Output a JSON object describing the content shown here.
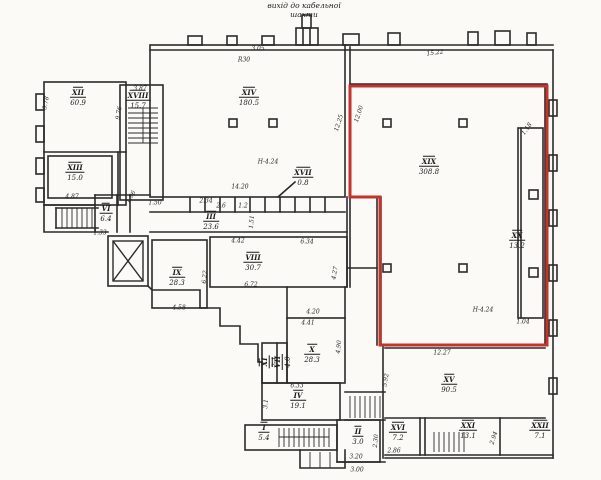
{
  "document": {
    "kind": "scanned hand-drawn floor plan",
    "paper_color": "#fbfaf6",
    "ink_color": "#2a2a2a"
  },
  "annotations": {
    "top_note_line1": "вихід до кабельної",
    "top_note_line2": "шахти"
  },
  "highlight": {
    "color": "#c4342c",
    "room_label": "XIX",
    "room_area": "308.8"
  },
  "plan": {
    "rooms": [
      {
        "label": "XII",
        "area": "60.9",
        "x": 78,
        "y": 97
      },
      {
        "label": "XVIII",
        "area": "15.7",
        "x": 138,
        "y": 100
      },
      {
        "label": "XIII",
        "area": "15.0",
        "x": 75,
        "y": 172
      },
      {
        "label": "XIV",
        "area": "180.5",
        "x": 249,
        "y": 97
      },
      {
        "label": "XIX",
        "area": "308.8",
        "x": 429,
        "y": 166
      },
      {
        "label": "XX",
        "area": "13.2",
        "x": 517,
        "y": 240
      },
      {
        "label": "VIII",
        "area": "30.7",
        "x": 253,
        "y": 262
      },
      {
        "label": "IX",
        "area": "28.3",
        "x": 177,
        "y": 277
      },
      {
        "label": "III",
        "area": "23.6",
        "x": 211,
        "y": 221
      },
      {
        "label": "VI",
        "area": "6.4",
        "x": 106,
        "y": 213
      },
      {
        "label": "X",
        "area": "28.3",
        "x": 312,
        "y": 354
      },
      {
        "label": "XI",
        "area": "2.1",
        "x": 269,
        "y": 362,
        "r": -90
      },
      {
        "label": "VII",
        "area": "4.0",
        "x": 282,
        "y": 362,
        "r": -90
      },
      {
        "label": "IV",
        "area": "19.1",
        "x": 298,
        "y": 400
      },
      {
        "label": "I",
        "area": "5.4",
        "x": 264,
        "y": 432
      },
      {
        "label": "II",
        "area": "3.0",
        "x": 358,
        "y": 436
      },
      {
        "label": "XV",
        "area": "90.5",
        "x": 449,
        "y": 384
      },
      {
        "label": "XVI",
        "area": "7.2",
        "x": 398,
        "y": 432
      },
      {
        "label": "XXI",
        "area": "13.1",
        "x": 468,
        "y": 430
      },
      {
        "label": "XXII",
        "area": "7.1",
        "x": 540,
        "y": 430
      },
      {
        "label": "XVII",
        "area": "0.8",
        "x": 303,
        "y": 177
      }
    ],
    "dimensions": [
      {
        "t": "15.22",
        "x": 435,
        "y": 53,
        "r": -7
      },
      {
        "t": "R30",
        "x": 244,
        "y": 60,
        "r": 0
      },
      {
        "t": "3.05",
        "x": 258,
        "y": 49,
        "r": 0
      },
      {
        "t": "3.87",
        "x": 140,
        "y": 89,
        "r": 0
      },
      {
        "t": "3.78",
        "x": 46,
        "y": 103,
        "r": -78
      },
      {
        "t": "9.76",
        "x": 119,
        "y": 113,
        "r": -80
      },
      {
        "t": "12.25",
        "x": 339,
        "y": 123,
        "r": -72
      },
      {
        "t": "12.00",
        "x": 359,
        "y": 114,
        "r": -72
      },
      {
        "t": "1.18",
        "x": 527,
        "y": 129,
        "r": -55
      },
      {
        "t": "14.20",
        "x": 240,
        "y": 187,
        "r": 0
      },
      {
        "t": "Н-4.24",
        "x": 268,
        "y": 162,
        "r": 0
      },
      {
        "t": "Н-4.24",
        "x": 483,
        "y": 310,
        "r": 0
      },
      {
        "t": "4.87",
        "x": 72,
        "y": 197,
        "r": 0
      },
      {
        "t": "1.96",
        "x": 131,
        "y": 197,
        "r": -60
      },
      {
        "t": "1.50",
        "x": 155,
        "y": 203,
        "r": 0
      },
      {
        "t": "2.34",
        "x": 206,
        "y": 201,
        "r": 0
      },
      {
        "t": "2.6",
        "x": 221,
        "y": 206,
        "r": 0
      },
      {
        "t": "1.2",
        "x": 243,
        "y": 206,
        "r": 0
      },
      {
        "t": "1.51",
        "x": 252,
        "y": 222,
        "r": -85
      },
      {
        "t": "6.22",
        "x": 205,
        "y": 277,
        "r": -85
      },
      {
        "t": "4.42",
        "x": 238,
        "y": 241,
        "r": 0
      },
      {
        "t": "6.34",
        "x": 307,
        "y": 242,
        "r": 0
      },
      {
        "t": "6.72",
        "x": 251,
        "y": 285,
        "r": 0
      },
      {
        "t": "4.27",
        "x": 335,
        "y": 273,
        "r": -80
      },
      {
        "t": "4.20",
        "x": 313,
        "y": 312,
        "r": 0
      },
      {
        "t": "4.41",
        "x": 308,
        "y": 323,
        "r": 0
      },
      {
        "t": "4.58",
        "x": 179,
        "y": 308,
        "r": 0
      },
      {
        "t": "4.90",
        "x": 339,
        "y": 347,
        "r": -85
      },
      {
        "t": "6.33",
        "x": 297,
        "y": 386,
        "r": 0
      },
      {
        "t": "3.1",
        "x": 266,
        "y": 404,
        "r": -85
      },
      {
        "t": "12.27",
        "x": 442,
        "y": 353,
        "r": 0
      },
      {
        "t": "5.92",
        "x": 386,
        "y": 380,
        "r": -80
      },
      {
        "t": "2.94",
        "x": 494,
        "y": 438,
        "r": -72
      },
      {
        "t": "2.86",
        "x": 394,
        "y": 451,
        "r": 0
      },
      {
        "t": "3.20",
        "x": 356,
        "y": 457,
        "r": 0
      },
      {
        "t": "3.00",
        "x": 357,
        "y": 470,
        "r": 0
      },
      {
        "t": "2.30",
        "x": 376,
        "y": 441,
        "r": -85
      },
      {
        "t": "1.04",
        "x": 523,
        "y": 322,
        "r": 0
      },
      {
        "t": "1.33",
        "x": 100,
        "y": 233,
        "r": 0
      }
    ]
  }
}
